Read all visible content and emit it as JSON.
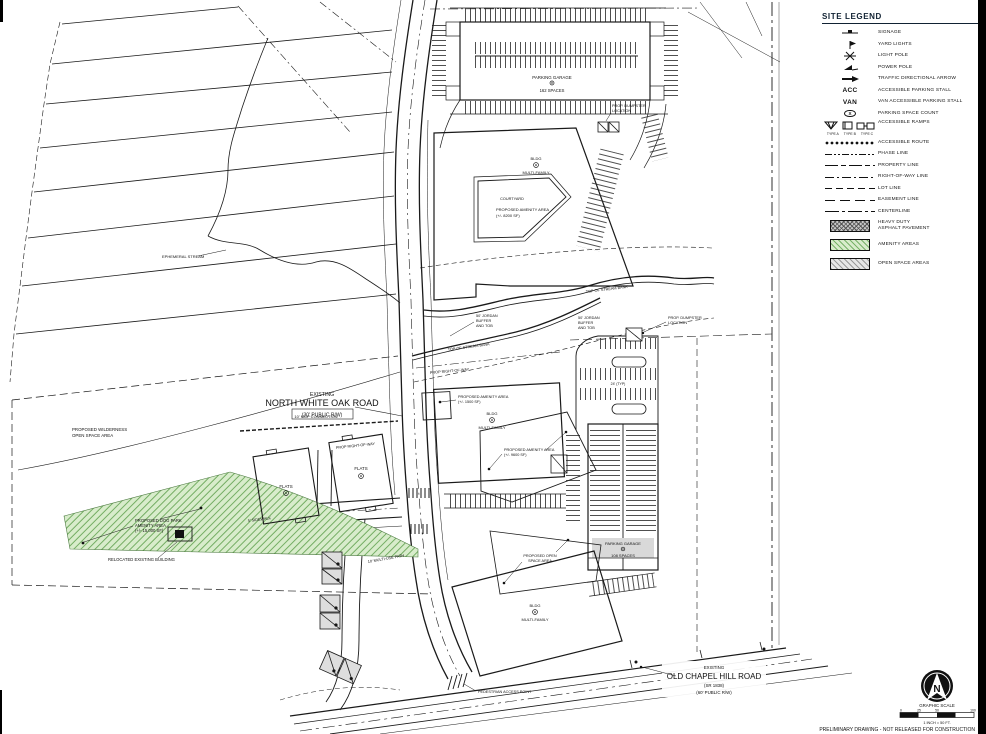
{
  "document": {
    "footer_note": "PRELIMINARY DRAWING - NOT RELEASED FOR CONSTRUCTION"
  },
  "legend": {
    "title": "SITE LEGEND",
    "items": [
      {
        "label": "SIGNAGE"
      },
      {
        "label": "YARD LIGHTS"
      },
      {
        "label": "LIGHT POLE"
      },
      {
        "label": "POWER POLE"
      },
      {
        "label": "TRAFFIC DIRECTIONAL ARROW"
      },
      {
        "symbol_text": "ACC",
        "label": "ACCESSIBLE PARKING STALL"
      },
      {
        "symbol_text": "VAN",
        "label": "VAN ACCESSIBLE PARKING STALL"
      },
      {
        "symbol_text": "X",
        "label": "PARKING SPACE COUNT"
      },
      {
        "label": "ACCESSIBLE RAMPS",
        "types": [
          "TYPE A",
          "TYPE B",
          "TYPE C"
        ]
      },
      {
        "label": "ACCESSIBLE ROUTE"
      },
      {
        "label": "PHASE LINE"
      },
      {
        "label": "PROPERTY LINE"
      },
      {
        "label": "RIGHT-OF-WAY LINE"
      },
      {
        "label": "LOT LINE"
      },
      {
        "label": "EASEMENT LINE"
      },
      {
        "label": "CENTERLINE"
      },
      {
        "label_lines": [
          "HEAVY DUTY",
          "ASPHALT PAVEMENT"
        ]
      },
      {
        "label": "AMENITY AREAS"
      },
      {
        "label": "OPEN SPACE AREAS"
      }
    ]
  },
  "plan": {
    "ephemeral_stream": "EPHEMERAL STREAM",
    "road_nwo": [
      "EXISTING",
      "NORTH WHITE OAK ROAD",
      "(30' PUBLIC R/W)"
    ],
    "mup_connection": "10' MUP CONNECTION",
    "wilderness": [
      "PROPOSED WILDERNESS",
      "OPEN SPACE AREA"
    ],
    "dog_park": [
      "PROPOSED DOG PARK",
      "AMENITY AREA",
      "(+/- 15,000 SF)"
    ],
    "relocated": "RELOCATED EXISTING BUILDING",
    "flats": "FLATS",
    "prop_row": "PROP RIGHT-OF-WAY",
    "sidewalk_5": "5' SIDEWALK",
    "mup_10": "10' MULTI-USE PATH",
    "garage_top": [
      "PARKING GARAGE",
      "162 SPACES"
    ],
    "garage_right": [
      "PARKING GARAGE",
      "108 SPACES"
    ],
    "dumpster": [
      "PROP. DUMPSTER",
      "LOCATION"
    ],
    "bldg": "BLDG",
    "multifamily": "MULTI-FAMILY",
    "courtyard": "COURTYARD",
    "amenity_area": "PROPOSED AMENITY AREA",
    "amenity_8200": "(+/- 8200 SF)",
    "amenity_1500": "(+/- 1500 SF)",
    "amenity_9600": "(+/- 9600 SF)",
    "open_space": [
      "PROPOSED OPEN",
      "SPACE AREA"
    ],
    "jordan": [
      "50' JORDAN",
      "BUFFER",
      "AND TOB"
    ],
    "tob": "TOP OF STREAM BANK",
    "pedestrian": "PEDESTRIAN ACCESS POINT",
    "road_och": [
      "EXISTING",
      "OLD CHAPEL HILL ROAD",
      "(SR 1838)",
      "(60' PUBLIC R/W)"
    ],
    "dim_24": "24' (TYP)"
  },
  "north": {
    "letter": "N"
  },
  "scale": {
    "title": "GRAPHIC SCALE",
    "ticks": [
      "0",
      "25",
      "50",
      "100"
    ],
    "caption": "1 INCH = 50 FT."
  },
  "colors": {
    "amenity_green_fill": "#d8eccb",
    "amenity_green_hatch": "#74ad63",
    "building_gray": "#d9d9d9",
    "open_space_fill": "#e7e7e7",
    "line_ink": "#1a1a1a"
  }
}
